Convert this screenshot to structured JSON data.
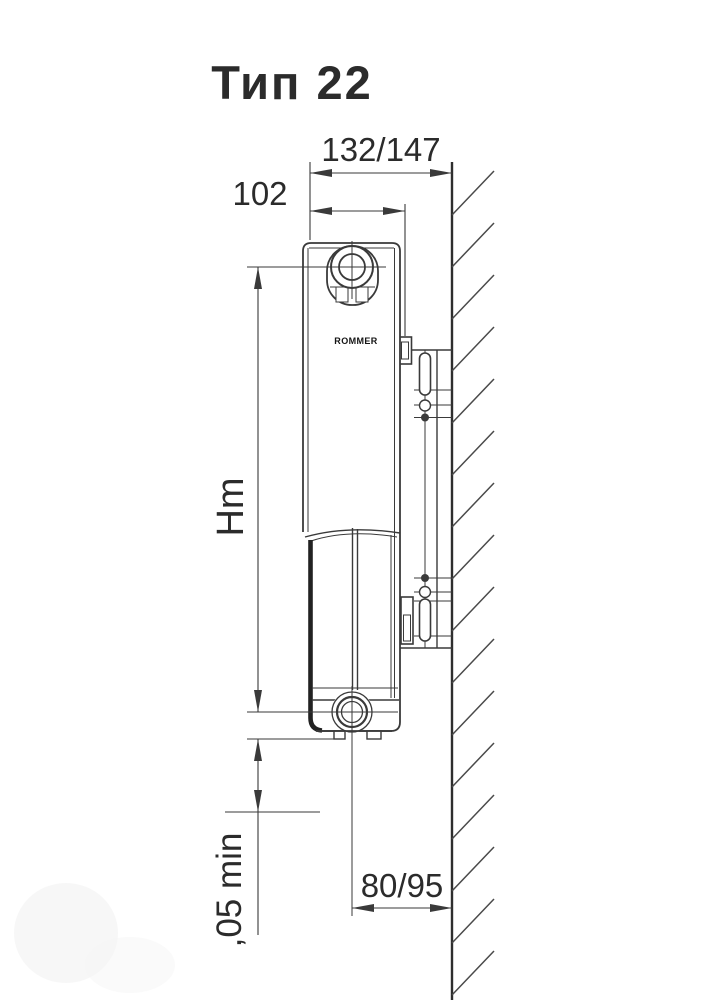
{
  "title": "Тип 22",
  "logo": "ROMMER",
  "dimensions": {
    "depth_to_wall": "132/147",
    "panel_depth": "102",
    "mounting_height": "Hm",
    "floor_clearance": ",05 min",
    "bottom_pipe_to_wall": "80/95"
  },
  "colors": {
    "background": "#ffffff",
    "ink": "#2b2b2b",
    "line": "#3a3a3a"
  }
}
